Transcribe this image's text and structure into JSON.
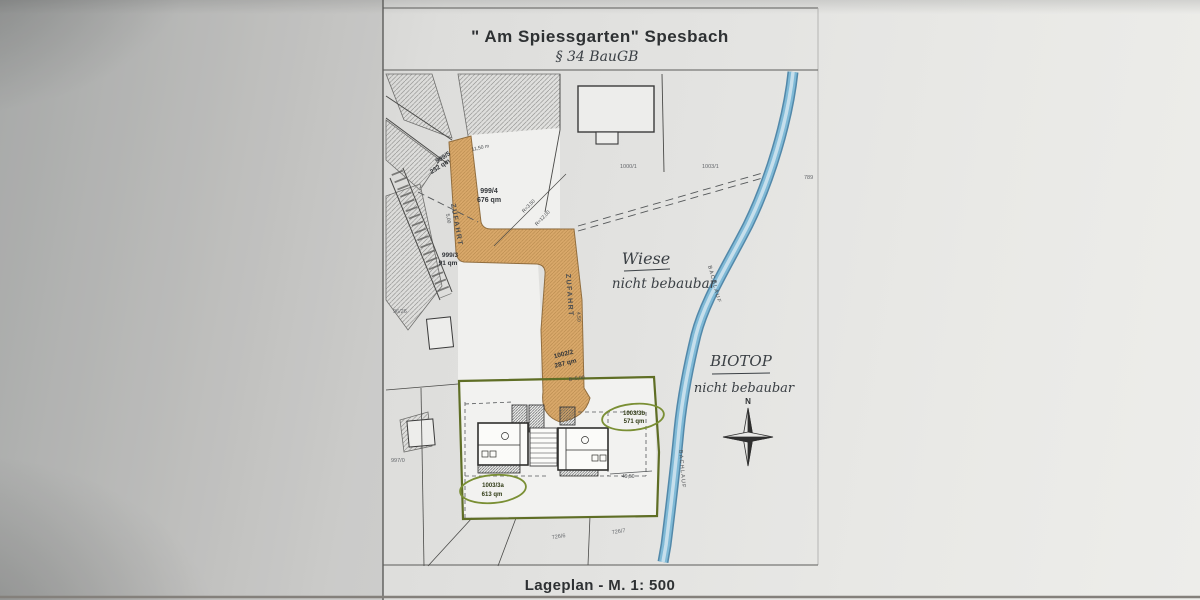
{
  "sheet": {
    "title": "\" Am Spiessgarten\" Spesbach",
    "paragraph_note": "§ 34  BauGB",
    "scale_caption": "Lageplan - M. 1: 500"
  },
  "map": {
    "driveway_label": "ZUFAHRT",
    "stream_label": "BACHLAUF",
    "compass_north": "N",
    "notes": {
      "wiese_title": "Wiese",
      "wiese_note": "nicht bebaubar",
      "biotop_title": "BIOTOP",
      "biotop_note": "nicht bebaubar"
    },
    "parcels": {
      "p999_5": {
        "id": "999/5",
        "area": "232 qm"
      },
      "p999_4": {
        "id": "999/4",
        "area": "676 qm"
      },
      "p999_3": {
        "id": "999/3",
        "area": "91 qm"
      },
      "p1002_2": {
        "id": "1002/2",
        "area": "287 qm"
      },
      "p1003_3b": {
        "id": "1003/3b",
        "area": "571 qm"
      },
      "p1003_3a": {
        "id": "1003/3a",
        "area": "613 qm"
      },
      "p1000_1": {
        "id": "1000/1"
      },
      "p1003_1": {
        "id": "1003/1"
      },
      "p789": {
        "id": "789"
      },
      "p96_26": {
        "id": "96/26"
      },
      "p997_0": {
        "id": "997/0"
      },
      "p726_6": {
        "id": "726/6"
      },
      "p726_7": {
        "id": "726/7"
      }
    },
    "dimensions": {
      "d_top": "11,50 m",
      "d_width_upper": "5,00",
      "d_width_mid": "4,50",
      "d_r1": "R=3,50",
      "d_r2": "R=12,00",
      "d_b": "B=5,00",
      "d_plot": "49,50"
    },
    "colors": {
      "driveway": "#d9a86a",
      "stream": "#7fb9d6",
      "plot_boundary": "#5f6e25",
      "green_oval": "#7a8f34",
      "ink": "#3a3a3a"
    }
  }
}
